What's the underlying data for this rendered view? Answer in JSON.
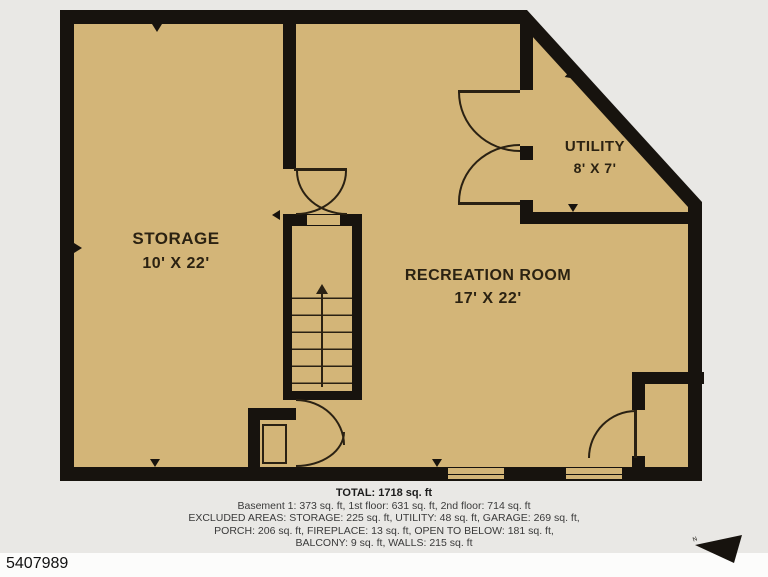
{
  "plan": {
    "rooms": [
      {
        "label": "STORAGE",
        "dims": "10' X 22'"
      },
      {
        "label": "RECREATION ROOM",
        "dims": "17' X 22'"
      },
      {
        "label": "UTILITY",
        "dims": "8' X 7'"
      }
    ]
  },
  "summary": {
    "total": "TOTAL: 1718 sq. ft",
    "floors": "Basement 1: 373 sq. ft, 1st floor: 631 sq. ft, 2nd floor: 714 sq. ft",
    "excluded1": "EXCLUDED AREAS: STORAGE: 225 sq. ft, UTILITY: 48 sq. ft, GARAGE: 269 sq. ft,",
    "excluded2": "PORCH: 206 sq. ft, FIREPLACE: 13 sq. ft, OPEN TO BELOW: 181 sq. ft,",
    "excluded3": "BALCONY: 9 sq. ft, WALLS: 215 sq. ft",
    "disclaimer": "MEASUREMENTS DEEMED HIGHLY RELIABLE BUT NOT GUARANTEED"
  },
  "listing_id": "5407989",
  "compass": {
    "label": "N"
  },
  "colors": {
    "floor": "#d3b578",
    "wall": "#17130e",
    "page_bg": "#e9e8e5",
    "footer_bar": "#fcfcfb"
  }
}
